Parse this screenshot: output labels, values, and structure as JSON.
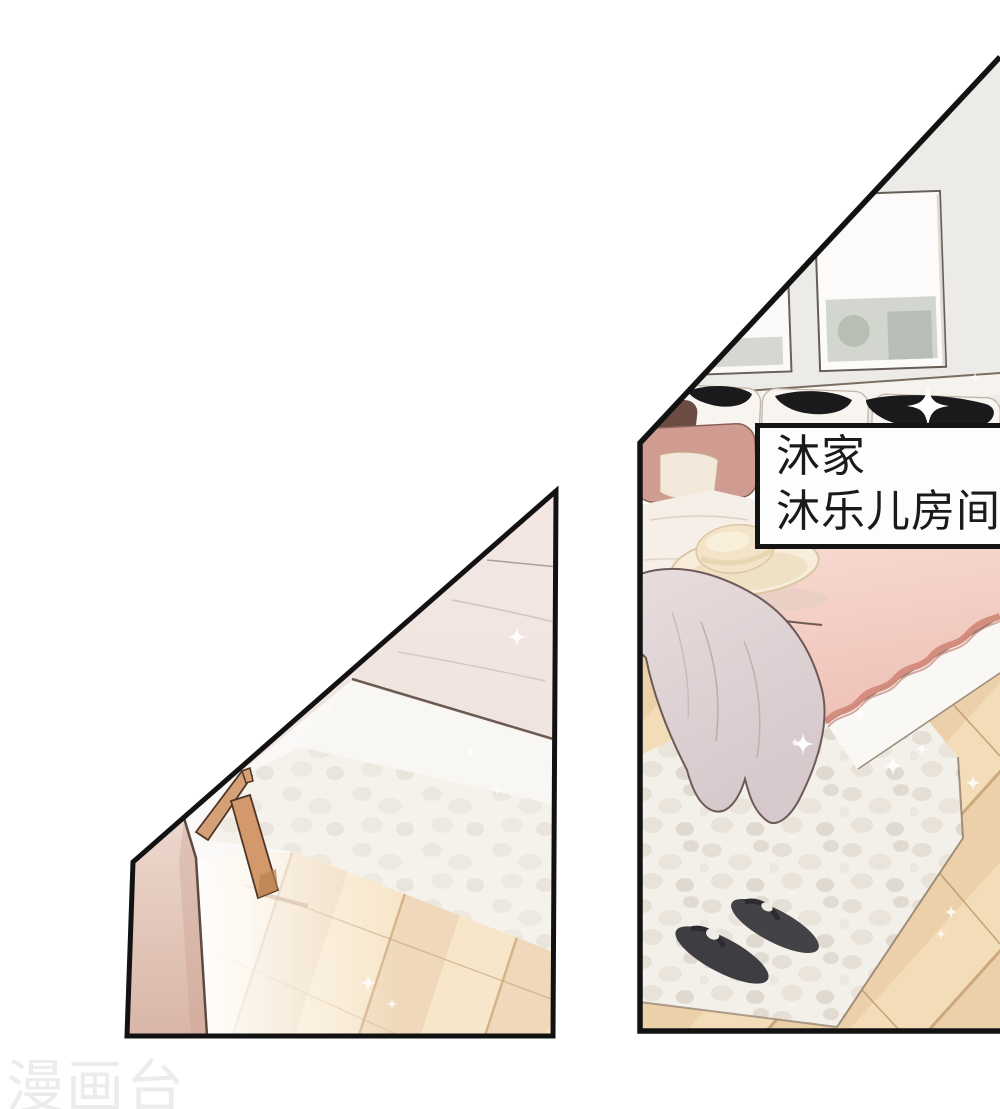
{
  "page": {
    "type": "manhua-comic-page",
    "width": 1000,
    "height": 1109,
    "background": "#ffffff"
  },
  "caption_box": {
    "lines": [
      "沐家",
      "沐乐儿房间"
    ],
    "text_color": "#1a1a1a",
    "background_color": "#fdfdfd",
    "border_color": "#141414"
  },
  "watermark": {
    "text": "漫画台",
    "color": "#ececec"
  },
  "panels": {
    "left": {
      "border_color": "#121212",
      "scene_objects": [
        "bed-white-sheets",
        "wood-chair-leg",
        "pink-wall",
        "fluffy-rug",
        "wood-floor",
        "sparkles"
      ]
    },
    "right": {
      "border_color": "#121212",
      "scene_objects": [
        "picture-frames",
        "pillows-black-brush",
        "maroon-pillow",
        "rose-pillow",
        "straw-hat",
        "pink-duvet",
        "trimmed-blanket",
        "draped-blanket",
        "fluffy-rug",
        "dark-slippers",
        "wood-floor",
        "sparkles"
      ]
    }
  },
  "palette": {
    "duvet_pink": "#f3cdc3",
    "trim_pink": "#d28a7b",
    "rug": "#f2efe9",
    "wood_floor": "#eed5b0",
    "wall_pink": "#e5c9bb",
    "slippers": "#3e3d41",
    "hat": "#f5ead4",
    "chair_wood": "#d6a077",
    "black_ink": "#1a191b"
  }
}
